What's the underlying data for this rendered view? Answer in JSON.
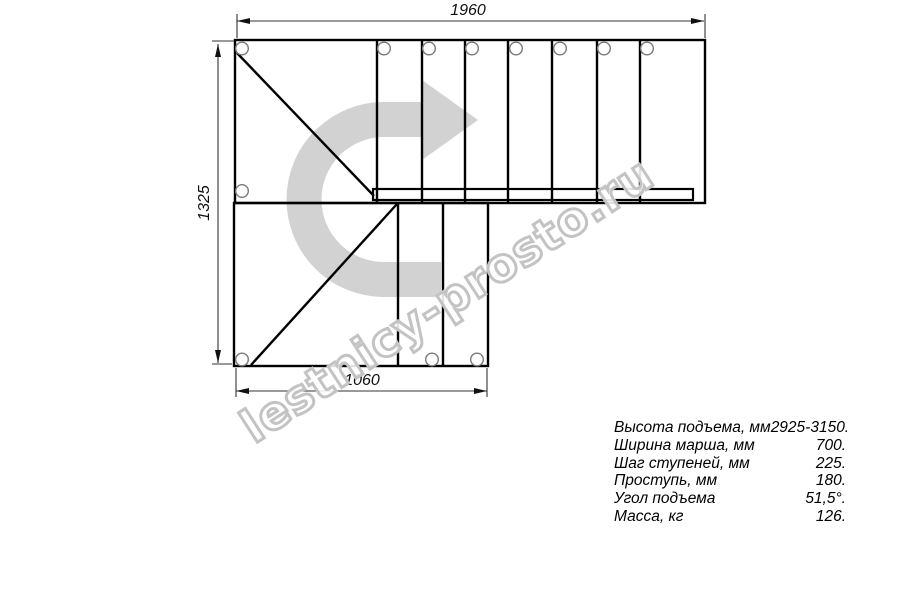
{
  "drawing": {
    "title": "L-shaped staircase plan",
    "dimensions": {
      "top": "1960",
      "left": "1325",
      "bottom": "1060"
    }
  },
  "watermark": {
    "text": "lestnicy-prosto.ru"
  },
  "specs": {
    "rows": [
      {
        "label": "Высота подъема, мм",
        "value": "2925-3150."
      },
      {
        "label": "Ширина марша, мм",
        "value": "700."
      },
      {
        "label": "Шаг ступеней, мм",
        "value": "225."
      },
      {
        "label": "Проступь, мм",
        "value": "180."
      },
      {
        "label": "Угол подъема",
        "value": "51,5°."
      },
      {
        "label": "Масса, кг",
        "value": "126."
      }
    ]
  },
  "colors": {
    "line": "#000000",
    "dimension_line": "#333333",
    "arrow_fill": "#d2d2d2",
    "circle_outline": "#7a7a7a",
    "watermark_outline": "#c3c3c3"
  }
}
